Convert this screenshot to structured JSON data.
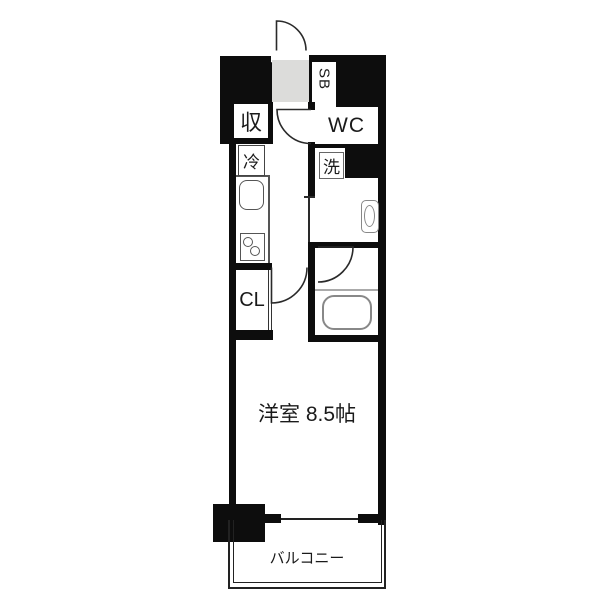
{
  "plan": {
    "type": "apartment-floor-plan",
    "labels": {
      "storage": "収",
      "fridge": "冷",
      "shoebox": "SB",
      "wc": "WC",
      "washer": "洗",
      "closet": "CL",
      "main_room": "洋室 8.5帖",
      "balcony": "バルコニー"
    },
    "colors": {
      "wall": "#0d0d0d",
      "genkan_floor": "#dcdcda",
      "fixture_stroke": "#888888",
      "line": "#2a2a2a",
      "background": "#ffffff"
    }
  }
}
